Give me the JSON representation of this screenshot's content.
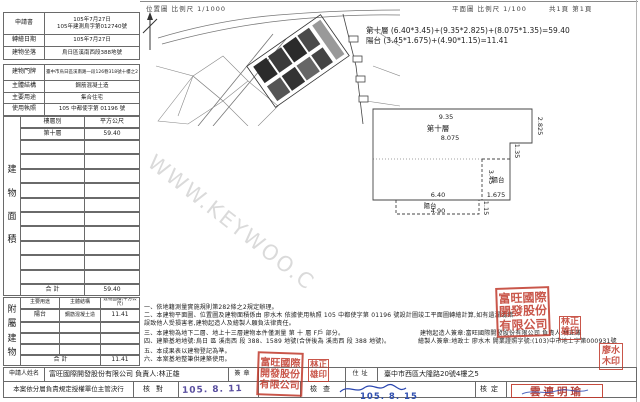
{
  "header": {
    "loc_scale": "位置圖 比例尺 1/1000",
    "plan_scale": "平面圖 比例尺 1/100",
    "pages": "共1頁 第1頁"
  },
  "info_rows": {
    "r1": {
      "label": "申請書",
      "value1": "105年7月27日",
      "value2": "105年建測烏字第012740號"
    },
    "r2": {
      "label": "轉繪日期",
      "value": "105年7月27日"
    },
    "r3": {
      "label": "建物坐落",
      "value": "烏日區溪南西段388地號"
    },
    "r4": {
      "label": "建物門牌",
      "value": "臺中市烏日區溪南路一段126巷318號十樓之2"
    },
    "r5": {
      "label": "主體結構",
      "value": "鋼筋混凝土造"
    },
    "r6": {
      "label": "主要用途",
      "value": "集合住宅"
    },
    "r7": {
      "label": "使用執照",
      "value": "105 中都使字第 01196 號"
    }
  },
  "floor_table": {
    "vertical_label": "建物面積",
    "col_floor": "樓層別",
    "col_area": "平方公尺",
    "row_floor": "第十層",
    "row_area": "59.40",
    "total_label": "合 計",
    "total_value": "59.40"
  },
  "annex_table": {
    "vertical_label": "附屬建物",
    "col_use": "主要用途",
    "col_structure": "主體結構",
    "col_area": "建物面積(平方公尺)",
    "row_use": "陽台",
    "row_structure": "鋼筋混凝土造",
    "row_area": "11.41",
    "total_label": "合 計",
    "total_value": "11.41"
  },
  "formulas": {
    "line1": "第十層 (6.40*3.45)+(9.35*2.825)+(8.075*1.35)=59.40",
    "line2": "陽台 (3.45*1.675)+(4.90*1.15)=11.41"
  },
  "plan_labels": {
    "dim_935": "9.35",
    "floor": "第十層",
    "dim_8075": "8.075",
    "dim_2825": "2.825",
    "dim_135": "1.35",
    "dim_345": "3.45",
    "balcony_right": "陽台",
    "dim_1675": "1.675",
    "dim_640": "6.40",
    "balcony_bottom": "陽台",
    "dim_490": "4.90",
    "dim_115": "1.15"
  },
  "notes": {
    "n0": "一、依地籍測量實施規則第282條之2規定辦理。",
    "n1": "二、本建物平面圖、位置圖及建物面積係由 廖水木 依據使用執照 105 中都使字第 01196 號設計圖竣工平面圖轉繪計算,如有遺漏或錯誤致他人受損害者,建物起造人及繪製人願負法律責任。",
    "n2": "三、本建物為地下二層、地上十三層建物本件僅測量 第 十 層 F戶 部分。",
    "n3": "四、建築基地地號:烏日 區 溪南西 段 388、1589 地號(合併後為 溪南西 段 388 地號)。",
    "n4": "五、本成果表以建物登記為準。",
    "n5": "六、本案基地整筆供建築使用。"
  },
  "sign_lines": {
    "builder": "建物起造人簽章:富旺國際開發股份有限公司 負責人:林正雄",
    "drafter": "繪製人簽章:地政士 廖水木 開業證照字號:(103)中市地士字第000931號"
  },
  "bottom": {
    "applicant_label": "申請人姓名",
    "applicant_value": "富旺國際開發股份有限公司 負責人:林正雄",
    "seal_label": "簽章",
    "addr_label": "住址",
    "addr_value": "臺中市西區大隆路20號4樓之5",
    "delegation": "本案依分層負責規定授權單位主管決行",
    "check": "核對",
    "inspect": "檢查",
    "approve": "核定"
  },
  "stamps": {
    "company_seal": "富旺國際開發股份有限公司",
    "lin_seal": "林正雄印",
    "liao_seal": "廖水木印",
    "approver": "雲連明瑜",
    "date_received": "105. 8. 11",
    "date_checked": "105. 8. 15"
  },
  "watermark": "WWW.KEYWOO.C",
  "colors": {
    "seal_red": "#c0392b",
    "date_purple": "#5a4fa0",
    "date_blue": "#3050b0",
    "ink_blue": "#2a46b0"
  }
}
